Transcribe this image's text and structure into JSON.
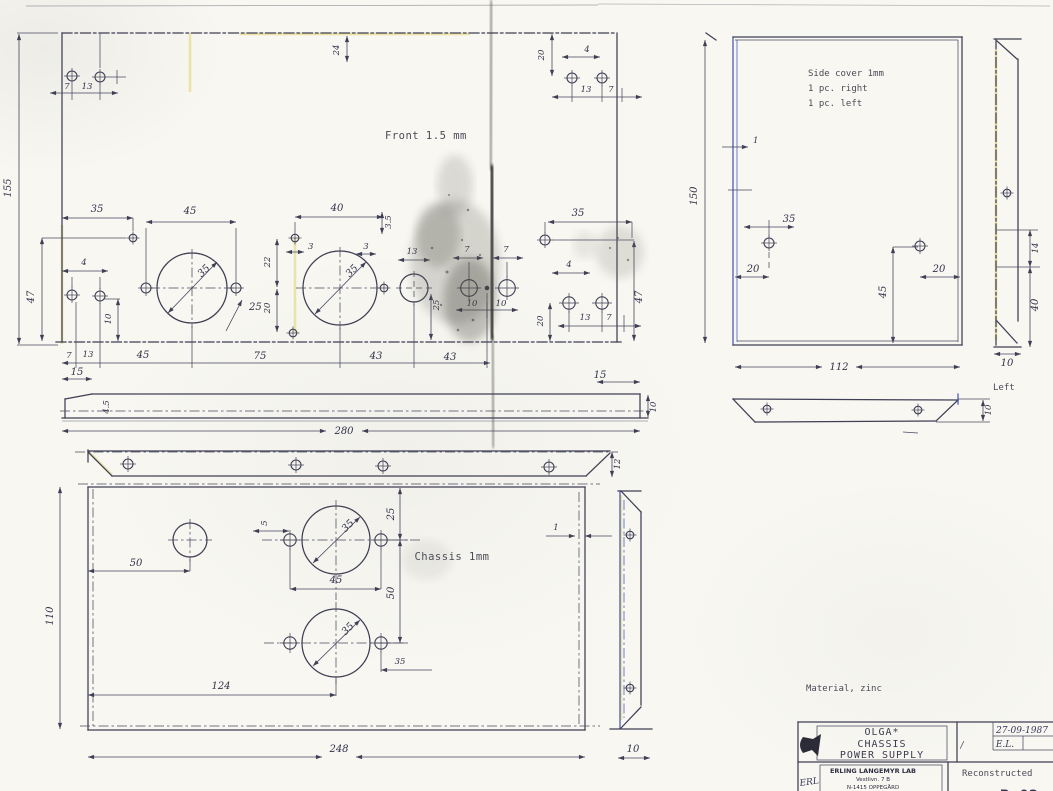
{
  "sheet": {
    "background": "#f8f7f1",
    "ink_color": "#3f3f55",
    "blue_accent": "#4656b8",
    "highlight_yellow": "#e5de92"
  },
  "notes": {
    "front": "Front 1.5 mm",
    "chassis": "Chassis 1mm",
    "side_cover_1": "Side cover 1mm",
    "side_cover_2": "1 pc. right",
    "side_cover_3": "1 pc. left",
    "material": "Material, zinc",
    "left_view": "Left"
  },
  "dims": {
    "front_height": "155",
    "front_top_v": "24",
    "front_tl_7": "7",
    "front_tl_13": "13",
    "front_tr_20": "20",
    "front_tr_4": "4",
    "front_tr_13": "13",
    "front_tr_7": "7",
    "front_35_left": "35",
    "front_45": "45",
    "front_47_left": "47",
    "front_4_left": "4",
    "front_10_left": "10",
    "front_c1_dia": "35",
    "front_25_c1": "25",
    "front_40": "40",
    "front_35_offset": "3.5",
    "front_22": "22",
    "front_3_col": "3",
    "front_20_col": "20",
    "front_c2_dia": "35",
    "front_3_side": "3",
    "front_13_mid": "13",
    "front_25_mid": "25",
    "front_7_m1": "7",
    "front_7_m2": "7",
    "front_10_m1": "10",
    "front_10_m2": "10",
    "front_35_right": "35",
    "front_4_right": "4",
    "front_20_right": "20",
    "front_13_right": "13",
    "front_7_right": "7",
    "front_47_right": "47",
    "front_b_7": "7",
    "front_b_13": "13",
    "front_b_45": "45",
    "front_b_75": "75",
    "front_b_43a": "43",
    "front_b_43b": "43",
    "strip_15_l": "15",
    "strip_15_r": "15",
    "strip_45": "4.5",
    "strip_10": "10",
    "strip_280": "280",
    "flange_12": "12",
    "ch_110": "110",
    "ch_50_left": "50",
    "ch_5": "5",
    "ch_25": "25",
    "ch_c1_dia": "35",
    "ch_45": "45",
    "ch_50": "50",
    "ch_c2_dia": "35",
    "ch_35_br": "35",
    "ch_1": "1",
    "ch_124": "124",
    "ch_248": "248",
    "ch_strip_10": "10",
    "sc_150": "150",
    "sc_1": "1",
    "sc_35": "35",
    "sc_20_l": "20",
    "sc_20_r": "20",
    "sc_45": "45",
    "sc_112": "112",
    "sv_14": "14",
    "sv_40": "40",
    "sv_10": "10",
    "st_10": "10"
  },
  "title_block": {
    "product_line1": "OLGA*",
    "product_line2": "CHASSIS",
    "product_line3": "POWER SUPPLY",
    "date": "27-09-1987",
    "initials": "E.L.",
    "check_mark": "/",
    "signature": "ERL",
    "company_name": "ERLING LANGEMYR LAB",
    "company_addr1": "Vestlivn. 7 B",
    "company_addr2": "N-1415 OPPEGÅRD",
    "status": "Reconstructed",
    "drawing_number": "B-02"
  }
}
